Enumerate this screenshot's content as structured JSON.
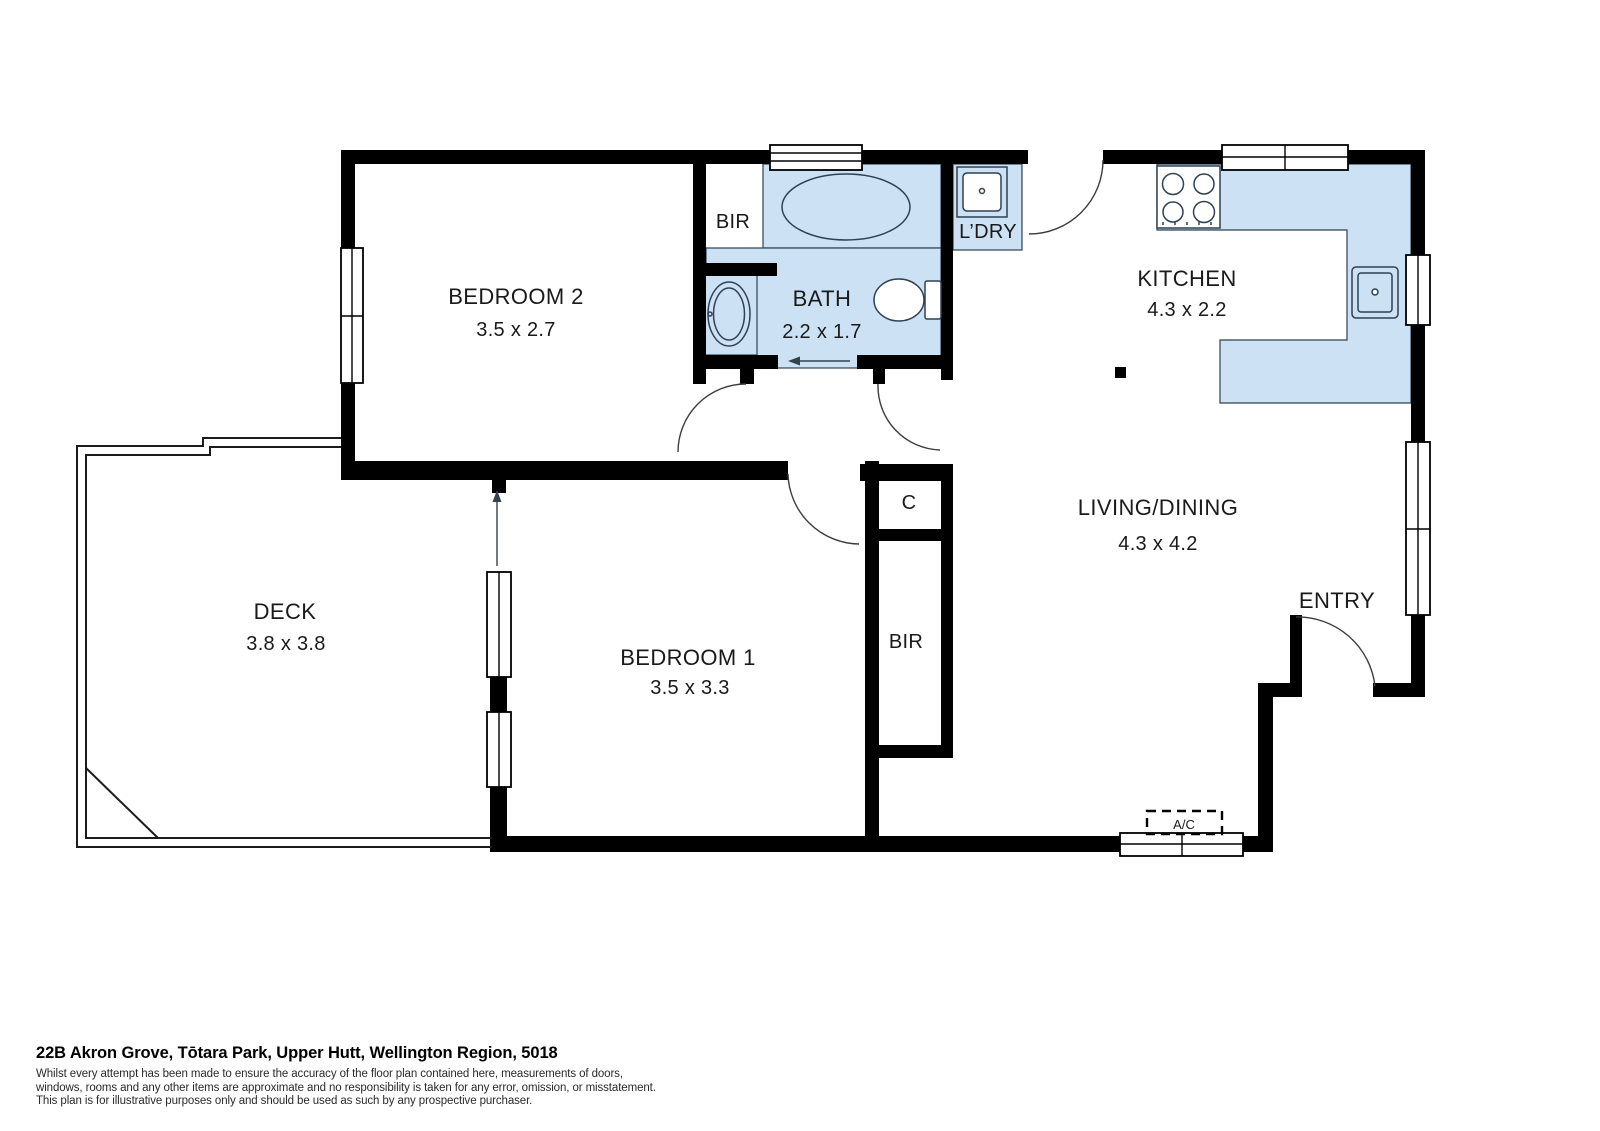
{
  "floorplan": {
    "colors": {
      "wet_area_fill": "#cce2f4",
      "wall": "#000000",
      "fixture_line": "#2f4152",
      "text": "#1a1a1a"
    },
    "rooms": {
      "bedroom2": {
        "name": "BEDROOM 2",
        "dims": "3.5 x 2.7"
      },
      "bedroom1": {
        "name": "BEDROOM 1",
        "dims": "3.5 x 3.3"
      },
      "bath": {
        "name": "BATH",
        "dims": "2.2 x 1.7"
      },
      "laundry": {
        "name": "L’DRY"
      },
      "kitchen": {
        "name": "KITCHEN",
        "dims": "4.3 x 2.2"
      },
      "living": {
        "name": "LIVING/DINING",
        "dims": "4.3 x 4.2"
      },
      "deck": {
        "name": "DECK",
        "dims": "3.8 x 3.8"
      },
      "entry": {
        "name": "ENTRY"
      },
      "closet": {
        "name": "C"
      },
      "bir_bath": {
        "name": "BIR"
      },
      "bir_bed1": {
        "name": "BIR"
      },
      "air_conditioner": {
        "name": "A/C"
      }
    },
    "fixtures": [
      "bathtub-icon",
      "toilet-icon",
      "vanity-basin-icon",
      "laundry-tub-icon",
      "stove-icon",
      "kitchen-sink-icon",
      "structural-post"
    ],
    "footer": {
      "address": "22B Akron Grove, Tōtara Park, Upper Hutt, Wellington Region, 5018",
      "disclaimer_lines": [
        "Whilst every attempt has been made to ensure the accuracy of the floor plan contained here, measurements of doors,",
        "windows, rooms and any other items are approximate and no responsibility is taken for any error, omission, or misstatement.",
        "This plan is for illustrative purposes only and should be used as such by any prospective purchaser."
      ]
    }
  }
}
